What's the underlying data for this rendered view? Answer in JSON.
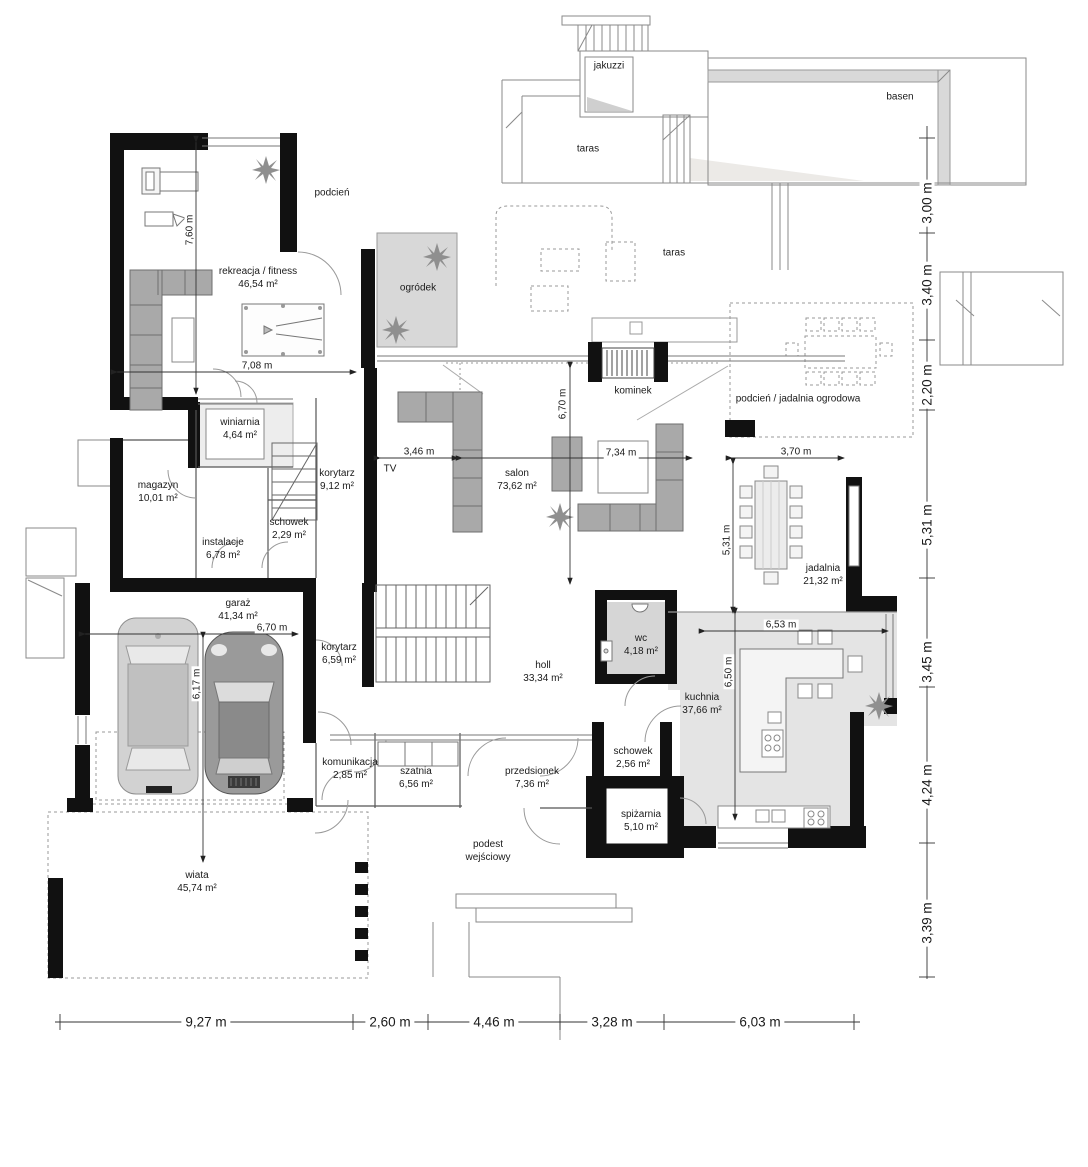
{
  "plan": {
    "zones": {
      "jakuzzi": {
        "label": "jakuzzi"
      },
      "basen": {
        "label": "basen"
      },
      "taras1": {
        "label": "taras"
      },
      "taras2": {
        "label": "taras"
      },
      "ogrodek": {
        "label": "ogródek"
      },
      "podcien": {
        "label": "podcień"
      },
      "kominek": {
        "label": "kominek"
      },
      "podcien_jadalnia": {
        "label": "podcień / jadalnia ogrodowa"
      },
      "tv": {
        "label": "TV"
      },
      "podest": {
        "label": "podest wejściowy"
      }
    },
    "rooms": {
      "fitness": {
        "label": "rekreacja / fitness",
        "area": "46,54 m²"
      },
      "winiarnia": {
        "label": "winiarnia",
        "area": "4,64 m²"
      },
      "magazyn": {
        "label": "magazyn",
        "area": "10,01 m²"
      },
      "korytarz1": {
        "label": "korytarz",
        "area": "9,12 m²"
      },
      "schowek1": {
        "label": "schowek",
        "area": "2,29 m²"
      },
      "instalacje": {
        "label": "instalacje",
        "area": "6,78 m²"
      },
      "salon": {
        "label": "salon",
        "area": "73,62 m²"
      },
      "jadalnia": {
        "label": "jadalnia",
        "area": "21,32 m²"
      },
      "garaz": {
        "label": "garaż",
        "area": "41,34 m²"
      },
      "korytarz2": {
        "label": "korytarz",
        "area": "6,59 m²"
      },
      "holl": {
        "label": "holl",
        "area": "33,34 m²"
      },
      "wc": {
        "label": "wc",
        "area": "4,18 m²"
      },
      "kuchnia": {
        "label": "kuchnia",
        "area": "37,66 m²"
      },
      "komunikacja": {
        "label": "komunikacja",
        "area": "2,85 m²"
      },
      "szatnia": {
        "label": "szatnia",
        "area": "6,56 m²"
      },
      "przedsionek": {
        "label": "przedsionek",
        "area": "7,36 m²"
      },
      "schowek2": {
        "label": "schowek",
        "area": "2,56 m²"
      },
      "spizarnia": {
        "label": "spiżarnia",
        "area": "5,10 m²"
      },
      "wiata": {
        "label": "wiata",
        "area": "45,74 m²"
      }
    },
    "dims_right": [
      "3,00 m",
      "3,40 m",
      "2,20 m",
      "5,31 m",
      "3,45 m",
      "4,24 m",
      "3,39 m"
    ],
    "dims_bottom": [
      "9,27 m",
      "2,60 m",
      "4,46 m",
      "3,28 m",
      "6,03 m"
    ],
    "dims_internal": {
      "d760": "7,60 m",
      "d708": "7,08 m",
      "d346": "3,46 m",
      "d734": "7,34 m",
      "d370": "3,70 m",
      "d670a": "6,70 m",
      "d531": "5,31 m",
      "d670b": "6,70 m",
      "d617": "6,17 m",
      "d653": "6,53 m",
      "d650": "6,50 m"
    },
    "colors": {
      "wall": "#111111",
      "furniture_gray": "#a9a9a9",
      "zone_gray": "#dcdcdc"
    }
  }
}
